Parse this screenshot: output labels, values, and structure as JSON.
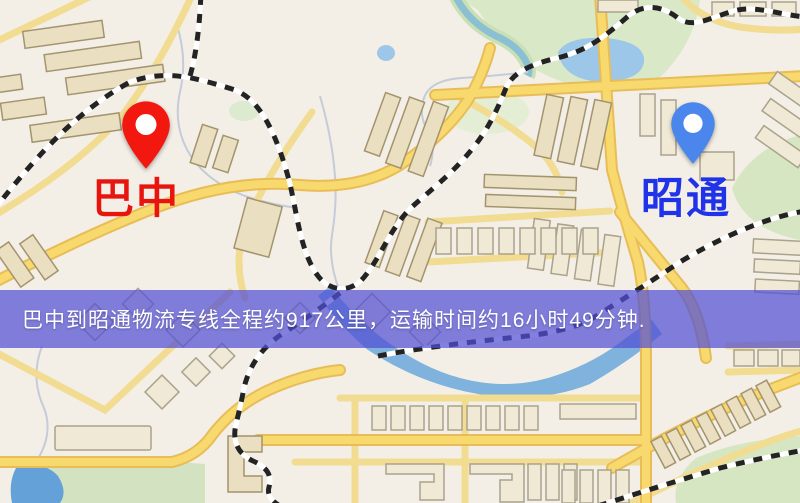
{
  "markers": {
    "origin": {
      "label": "巴中",
      "pin_color": "#f2180f",
      "label_color": "#e8150f"
    },
    "destination": {
      "label": "昭通",
      "pin_color": "#4a86ec",
      "label_color": "#2133e8"
    }
  },
  "banner": {
    "text": "巴中到昭通物流专线全程约917公里，运输时间约16小时49分钟.",
    "origin": "巴中",
    "destination": "昭通",
    "distance_km": 917,
    "duration_hours": 16,
    "duration_minutes": 49,
    "background": "rgba(82,79,214,0.72)",
    "text_color": "#ffffff"
  },
  "map_palette": {
    "land": "#f3efe6",
    "park": "#d9e8c7",
    "water": "#9dc7e8",
    "road": "#f8d96e",
    "road_casing": "#e8bd58",
    "building": "#eadfc0",
    "railway": "#232323"
  }
}
